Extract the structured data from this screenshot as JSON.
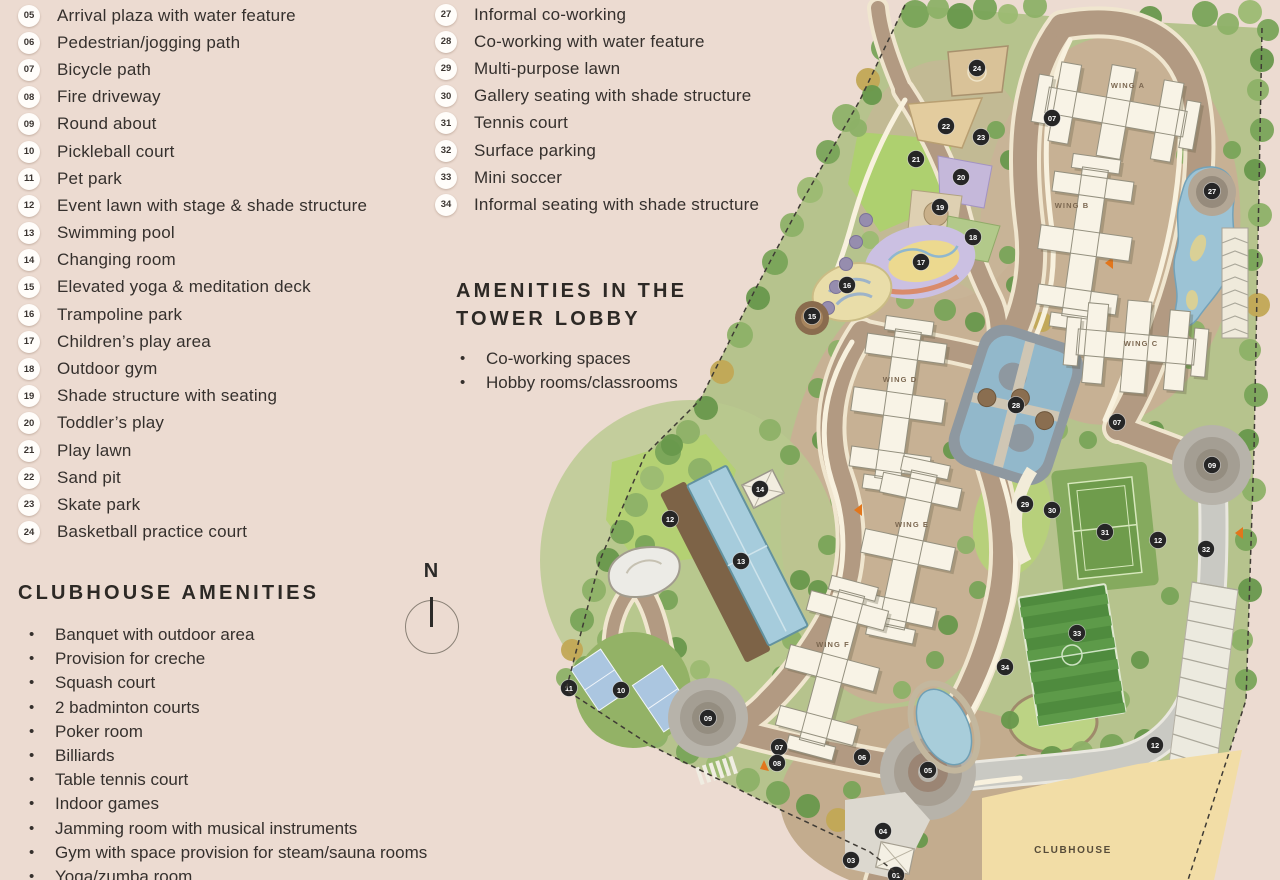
{
  "colors": {
    "background": "#ecdbd1",
    "text": "#35302d",
    "marker_bg": "#262626",
    "marker_text": "#ffffff",
    "badge_bg": "#fffdfa"
  },
  "legend_primary": {
    "items": [
      {
        "num": "05",
        "label": "Arrival plaza with water feature"
      },
      {
        "num": "06",
        "label": "Pedestrian/jogging path"
      },
      {
        "num": "07",
        "label": "Bicycle path"
      },
      {
        "num": "08",
        "label": "Fire driveway"
      },
      {
        "num": "09",
        "label": "Round about"
      },
      {
        "num": "10",
        "label": "Pickleball court"
      },
      {
        "num": "11",
        "label": "Pet park"
      },
      {
        "num": "12",
        "label": "Event lawn with stage & shade structure"
      },
      {
        "num": "13",
        "label": "Swimming pool"
      },
      {
        "num": "14",
        "label": "Changing room"
      },
      {
        "num": "15",
        "label": "Elevated yoga & meditation deck"
      },
      {
        "num": "16",
        "label": "Trampoline park"
      },
      {
        "num": "17",
        "label": "Children’s play area"
      },
      {
        "num": "18",
        "label": "Outdoor gym"
      },
      {
        "num": "19",
        "label": "Shade structure with seating"
      },
      {
        "num": "20",
        "label": "Toddler’s play"
      },
      {
        "num": "21",
        "label": "Play lawn"
      },
      {
        "num": "22",
        "label": "Sand pit"
      },
      {
        "num": "23",
        "label": "Skate park"
      },
      {
        "num": "24",
        "label": "Basketball practice court"
      }
    ]
  },
  "legend_secondary": {
    "items": [
      {
        "num": "27",
        "label": "Informal co-working"
      },
      {
        "num": "28",
        "label": "Co-working with water feature"
      },
      {
        "num": "29",
        "label": "Multi-purpose lawn"
      },
      {
        "num": "30",
        "label": "Gallery seating with shade structure"
      },
      {
        "num": "31",
        "label": "Tennis court"
      },
      {
        "num": "32",
        "label": "Surface parking"
      },
      {
        "num": "33",
        "label": "Mini soccer"
      },
      {
        "num": "34",
        "label": "Informal seating with shade structure"
      }
    ]
  },
  "tower_lobby": {
    "title_lines": [
      "AMENITIES IN THE",
      "TOWER LOBBY"
    ],
    "items": [
      "Co-working spaces",
      "Hobby rooms/classrooms"
    ]
  },
  "clubhouse_amenities": {
    "title": "CLUBHOUSE AMENITIES",
    "items": [
      "Banquet with outdoor area",
      "Provision for creche",
      "Squash court",
      "2 badminton courts",
      "Poker room",
      "Billiards",
      "Table tennis court",
      "Indoor games",
      "Jamming room with musical instruments",
      "Gym with space provision for steam/sauna rooms",
      "Yoga/zumba room"
    ]
  },
  "compass": {
    "label": "N"
  },
  "map": {
    "clubhouse_label": "CLUBHOUSE",
    "wings": [
      {
        "label": "WING A",
        "x": 1128,
        "y": 85,
        "sx": 1116,
        "sy": 112,
        "rot": 100,
        "len": 140
      },
      {
        "label": "WING B",
        "x": 1072,
        "y": 205,
        "sx": 1085,
        "sy": 243,
        "rot": 8,
        "len": 150
      },
      {
        "label": "WING C",
        "x": 1141,
        "y": 343,
        "sx": 1136,
        "sy": 347,
        "rot": 95,
        "len": 118
      },
      {
        "label": "WING D",
        "x": 900,
        "y": 379,
        "sx": 898,
        "sy": 405,
        "rot": 8,
        "len": 150
      },
      {
        "label": "WING E",
        "x": 912,
        "y": 524,
        "sx": 908,
        "sy": 550,
        "rot": 12,
        "len": 158
      },
      {
        "label": "WING F",
        "x": 833,
        "y": 644,
        "sx": 832,
        "sy": 668,
        "rot": 15,
        "len": 155
      }
    ],
    "markers": [
      {
        "n": "24",
        "x": 977,
        "y": 68
      },
      {
        "n": "07",
        "x": 1052,
        "y": 118
      },
      {
        "n": "22",
        "x": 946,
        "y": 126
      },
      {
        "n": "23",
        "x": 981,
        "y": 137
      },
      {
        "n": "21",
        "x": 916,
        "y": 159
      },
      {
        "n": "20",
        "x": 961,
        "y": 177
      },
      {
        "n": "27",
        "x": 1212,
        "y": 191
      },
      {
        "n": "19",
        "x": 940,
        "y": 207
      },
      {
        "n": "18",
        "x": 973,
        "y": 237
      },
      {
        "n": "17",
        "x": 921,
        "y": 262
      },
      {
        "n": "16",
        "x": 847,
        "y": 285
      },
      {
        "n": "15",
        "x": 812,
        "y": 316
      },
      {
        "n": "28",
        "x": 1016,
        "y": 405
      },
      {
        "n": "07",
        "x": 1117,
        "y": 422
      },
      {
        "n": "09",
        "x": 1212,
        "y": 465
      },
      {
        "n": "14",
        "x": 760,
        "y": 489
      },
      {
        "n": "29",
        "x": 1025,
        "y": 504
      },
      {
        "n": "30",
        "x": 1052,
        "y": 510
      },
      {
        "n": "12",
        "x": 670,
        "y": 519
      },
      {
        "n": "31",
        "x": 1105,
        "y": 532
      },
      {
        "n": "12",
        "x": 1158,
        "y": 540
      },
      {
        "n": "32",
        "x": 1206,
        "y": 549
      },
      {
        "n": "13",
        "x": 741,
        "y": 561
      },
      {
        "n": "33",
        "x": 1077,
        "y": 633
      },
      {
        "n": "34",
        "x": 1005,
        "y": 667
      },
      {
        "n": "11",
        "x": 569,
        "y": 688
      },
      {
        "n": "10",
        "x": 621,
        "y": 690
      },
      {
        "n": "09",
        "x": 708,
        "y": 718
      },
      {
        "n": "12",
        "x": 1155,
        "y": 745
      },
      {
        "n": "07",
        "x": 779,
        "y": 747
      },
      {
        "n": "06",
        "x": 862,
        "y": 757
      },
      {
        "n": "08",
        "x": 777,
        "y": 763
      },
      {
        "n": "05",
        "x": 928,
        "y": 770
      },
      {
        "n": "04",
        "x": 883,
        "y": 831
      },
      {
        "n": "03",
        "x": 851,
        "y": 860
      },
      {
        "n": "01",
        "x": 896,
        "y": 875
      }
    ]
  }
}
